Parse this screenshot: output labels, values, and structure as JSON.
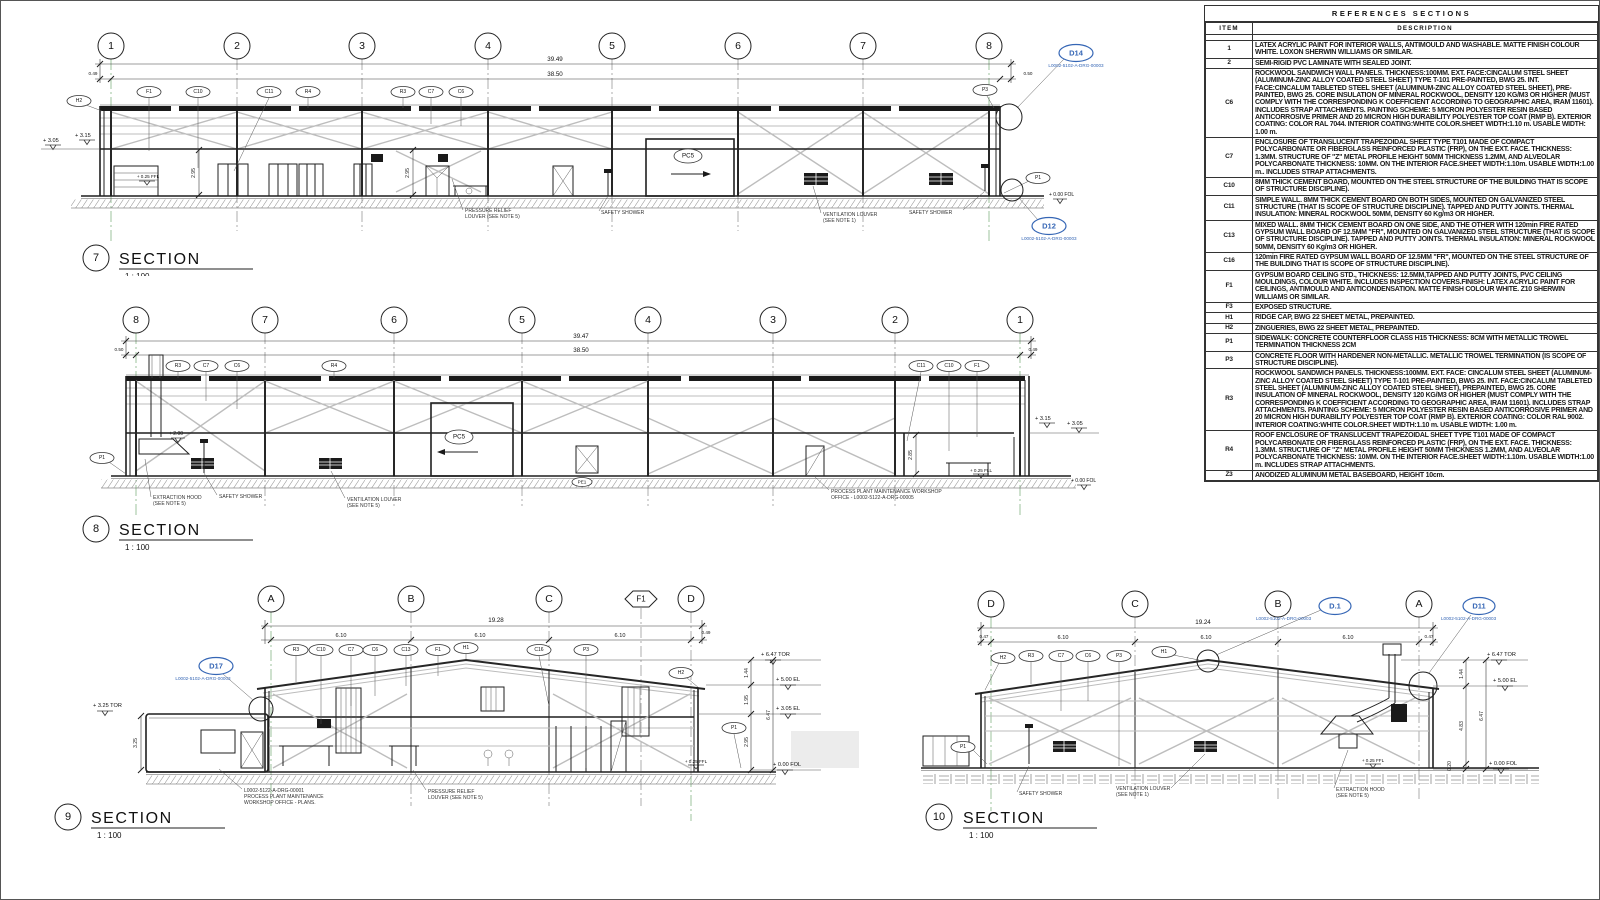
{
  "lbl": {
    "section": "SECTION",
    "scale": "1 : 100",
    "pc5": "PC5",
    "safety_shower": "SAFETY SHOWER",
    "vent_louver": "VENTILATION LOUVER",
    "note1": "(SEE NOTE 1)",
    "note5": "(SEE NOTE 5)",
    "pressure_relief": "PRESSURE RELIEF",
    "pressure_relief2": "LOUVER (SEE NOTE 5)",
    "extraction_hood": "EXTRACTION HOOD",
    "callout_ref": "L0002-5102-A-DRG-00003",
    "ffl": "+ 0.25 FFL",
    "fol": "+ 0.00 FOL",
    "tor_647": "+ 6.47 TOR",
    "el_500": "+ 5.00 EL",
    "el_305": "+ 3.05 EL",
    "d_144": "1.44",
    "d_647": "6.47",
    "d_610": "6.10"
  },
  "s7": {
    "num": "7",
    "grids": [
      "1",
      "2",
      "3",
      "4",
      "5",
      "6",
      "7",
      "8"
    ],
    "dim_total": "39.49",
    "dim_inner": "38.50",
    "dim_left": "0.49",
    "dim_right": "0.50",
    "el_305": "+ 3.05",
    "el_315": "+ 3.15",
    "h_room1": "2.95",
    "h_room2": "2.95",
    "tags": {
      "h2": "H2",
      "f1": "F1",
      "c10": "C10",
      "c11": "C11",
      "r4": "R4",
      "r3": "R3",
      "c7": "C7",
      "c6": "C6",
      "p3": "P3",
      "p1": "P1"
    },
    "callout_top": "D14",
    "callout_bot": "D12"
  },
  "s8": {
    "num": "8",
    "grids": [
      "8",
      "7",
      "6",
      "5",
      "4",
      "3",
      "2",
      "1"
    ],
    "dim_total": "39.47",
    "dim_inner": "38.50",
    "dim_left": "0.50",
    "dim_right": "0.49",
    "el_200": "+ 2.00",
    "el_315": "+ 3.15",
    "el_305": "+ 3.05",
    "ffl": "+ 0.25 FLL",
    "fol": "+ 0.00 FOL",
    "h_office": "2.85",
    "tags": {
      "r3": "R3",
      "c7": "C7",
      "c6": "C6",
      "r4": "R4",
      "c11": "C11",
      "c10": "C10",
      "f1": "F1",
      "p1": "P1",
      "pe1": "PE1"
    },
    "office_label1": "PROCESS PLANT MAINTENANCE WORKSHOP",
    "office_label2": "OFFICE - L0002-5122-A-DRG-00005"
  },
  "s9": {
    "num": "9",
    "grids": [
      "A",
      "B",
      "C",
      "F1",
      "D"
    ],
    "dim_total": "19.28",
    "dim_right": "0.49",
    "tor_325": "+ 3.25 TOR",
    "h_annex": "3.25",
    "d_195": "1.95",
    "d_295": "2.95",
    "tags": {
      "r3": "R3",
      "c10": "C10",
      "c7": "C7",
      "c6": "C6",
      "c13": "C13",
      "f1": "F1",
      "h1": "H1",
      "c16": "C16",
      "p3": "P3",
      "h2": "H2",
      "p1": "P1"
    },
    "callout": "D17",
    "annex_label1": "L0002-5122-A-DRG-00001",
    "annex_label2": "PROCESS PLANT MAINTENANCE",
    "annex_label3": "WORKSHOP OFFICE - PLANS."
  },
  "s10": {
    "num": "10",
    "grids": [
      "D",
      "C",
      "B",
      "A"
    ],
    "dim_total": "19.24",
    "dim_left": "0.47",
    "dim_right": "0.47",
    "d_483": "4.83",
    "d_020": "0.20",
    "tags": {
      "h2": "H2",
      "r3": "R3",
      "c7": "C7",
      "c6": "C6",
      "p3": "P3",
      "h1": "H1",
      "p1": "P1"
    },
    "callout_ridge": "D.1",
    "callout_corner": "D11"
  },
  "table": {
    "title": "REFERENCES SECTIONS",
    "col_item": "ITEM",
    "col_desc": "DESCRIPTION",
    "rows": [
      {
        "item": "1",
        "desc": "LATEX ACRYLIC PAINT FOR INTERIOR WALLS, ANTIMOULD AND WASHABLE. MATTE FINISH COLOUR WHITE. LOXON SHERWIN WILLIAMS OR SIMILAR."
      },
      {
        "item": "2",
        "desc": "SEMI-RIGID PVC LAMINATE WITH SEALED JOINT."
      },
      {
        "item": "C6",
        "desc": "ROCKWOOL SANDWICH WALL PANELS. THICKNESS:100MM. EXT. FACE:CINCALUM STEEL SHEET (ALUMINUM-ZINC ALLOY COATED STEEL SHEET) TYPE T-101 PRE-PAINTED, BWG 25. INT. FACE:CINCALUM TABLETED STEEL SHEET (ALUMINUM-ZINC ALLOY COATED STEEL SHEET), PRE-PAINTED, BWG 25. CORE INSULATION OF MINERAL ROCKWOOL, DENSITY 120 KG/M3 OR HIGHER (MUST COMPLY WITH THE CORRESPONDING K COEFFICIENT ACCORDING TO GEOGRAPHIC AREA, IRAM 11601). INCLUDES STRAP ATTACHMENTS. PAINTING SCHEME: 5 MICRON POLYESTER RESIN BASED ANTICORROSIVE PRIMER AND 20 MICRON HIGH DURABILITY POLYESTER TOP COAT (RMP B). EXTERIOR COATING: COLOR RAL 7044. INTERIOR COATING:WHITE COLOR.SHEET WIDTH:1.10 m. USABLE WIDTH: 1.00 m."
      },
      {
        "item": "C7",
        "desc": "ENCLOSURE OF TRANSLUCENT TRAPEZOIDAL SHEET TYPE T101 MADE OF COMPACT POLYCARBONATE OR FIBERGLASS REINFORCED PLASTIC (FRP), ON THE EXT. FACE. THICKNESS: 1.3MM. STRUCTURE OF \"Z\" METAL PROFILE HEIGHT 50MM THICKNESS 1.2MM, AND ALVEOLAR POLYCARBONATE THICKNESS: 10MM. ON THE INTERIOR FACE.SHEET WIDTH:1.10m. USABLE WIDTH:1.00 m.. INCLUDES STRAP ATTACHMENTS."
      },
      {
        "item": "C10",
        "desc": "8MM THICK CEMENT BOARD, MOUNTED ON THE STEEL STRUCTURE OF THE BUILDING THAT IS SCOPE OF STRUCTURE DISCIPLINE)."
      },
      {
        "item": "C11",
        "desc": "SIMPLE WALL. 8MM THICK CEMENT BOARD ON BOTH SIDES, MOUNTED ON GALVANIZED STEEL STRUCTURE (THAT IS SCOPE OF STRUCTURE DISCIPLINE). TAPPED AND PUTTY JOINTS. THERMAL INSULATION: MINERAL ROCKWOOL 50MM, DENSITY 60 Kg/m3 OR HIGHER."
      },
      {
        "item": "C13",
        "desc": "MIXED WALL. 8MM THICK CEMENT BOARD ON ONE SIDE, AND THE OTHER WITH 120min FIRE RATED GYPSUM WALL BOARD OF 12.5MM \"FR\", MOUNTED ON GALVANIZED STEEL STRUCTURE (THAT IS SCOPE OF STRUCTURE DISCIPLINE). TAPPED AND PUTTY JOINTS. THERMAL INSULATION: MINERAL ROCKWOOL 50MM, DENSITY 60 Kg/m3 OR HIGHER."
      },
      {
        "item": "C16",
        "desc": "120min FIRE RATED GYPSUM WALL BOARD OF 12.5MM \"FR\", MOUNTED ON THE STEEL STRUCTURE OF THE BUILDING THAT IS SCOPE OF STRUCTURE DISCIPLINE)."
      },
      {
        "item": "F1",
        "desc": "GYPSUM BOARD CEILING STD., THICKNESS: 12.5MM,TAPPED AND PUTTY JOINTS, PVC CEILING MOULDINGS, COLOUR WHITE. INCLUDES INSPECTION COVERS.FINISH: LATEX ACRYLIC PAINT FOR CEILINGS, ANTIMOULD AND ANTICONDENSATION. MATTE FINISH COLOUR WHITE. Z10 SHERWIN WILLIAMS OR SIMILAR."
      },
      {
        "item": "F3",
        "desc": "EXPOSED STRUCTURE."
      },
      {
        "item": "H1",
        "desc": "RIDGE CAP, BWG 22 SHEET METAL, PREPAINTED."
      },
      {
        "item": "H2",
        "desc": "ZINGUERIES, BWG 22 SHEET METAL, PREPAINTED."
      },
      {
        "item": "P1",
        "desc": "SIDEWALK: CONCRETE COUNTERFLOOR CLASS H15 THICKNESS: 8CM WITH METALLIC TROWEL TERMINATION THICKNESS 2CM"
      },
      {
        "item": "P3",
        "desc": "CONCRETE FLOOR WITH HARDENER NON-METALLIC. METALLIC TROWEL TERMINATION (IS SCOPE OF STRUCTURE DISCIPLINE)."
      },
      {
        "item": "R3",
        "desc": "ROCKWOOL SANDWICH PANELS. THICKNESS:100MM. EXT. FACE: CINCALUM STEEL SHEET (ALUMINUM-ZINC ALLOY COATED STEEL SHEET) TYPE T-101 PRE-PAINTED, BWG 25. INT. FACE:CINCALUM TABLETED STEEL SHEET (ALUMINUM-ZINC ALLOY COATED STEEL SHEET), PREPAINTED, BWG 25. CORE INSULATION OF MINERAL ROCKWOOL, DENSITY 120 KG/M3 OR HIGHER (MUST COMPLY WITH THE CORRESPONDING K COEFFICIENT ACCORDING TO GEOGRAPHIC AREA, IRAM 11601). INCLUDES STRAP ATTACHMENTS. PAINTING SCHEME: 5 MICRON POLYESTER RESIN BASED ANTICORROSIVE PRIMER AND 20 MICRON HIGH DURABILITY POLYESTER TOP COAT (RMP B). EXTERIOR COATING: COLOR RAL 9002. INTERIOR COATING:WHITE COLOR.SHEET WIDTH:1.10 m. USABLE WIDTH: 1.00 m."
      },
      {
        "item": "R4",
        "desc": "ROOF ENCLOSURE OF TRANSLUCENT TRAPEZOIDAL SHEET TYPE T101 MADE OF COMPACT POLYCARBONATE OR FIBERGLASS REINFORCED PLASTIC (FRP), ON THE EXT. FACE. THICKNESS: 1.3MM. STRUCTURE OF \"Z\" METAL PROFILE HEIGHT 50MM THICKNESS 1.2MM, AND ALVEOLAR POLYCARBONATE THICKNESS: 10MM. ON THE INTERIOR FACE.SHEET WIDTH:1.10m. USABLE WIDTH:1.00 m. INCLUDES STRAP ATTACHMENTS."
      },
      {
        "item": "Z3",
        "desc": "ANODIZED ALUMINUM METAL BASEBOARD, HEIGHT 10cm."
      }
    ]
  }
}
